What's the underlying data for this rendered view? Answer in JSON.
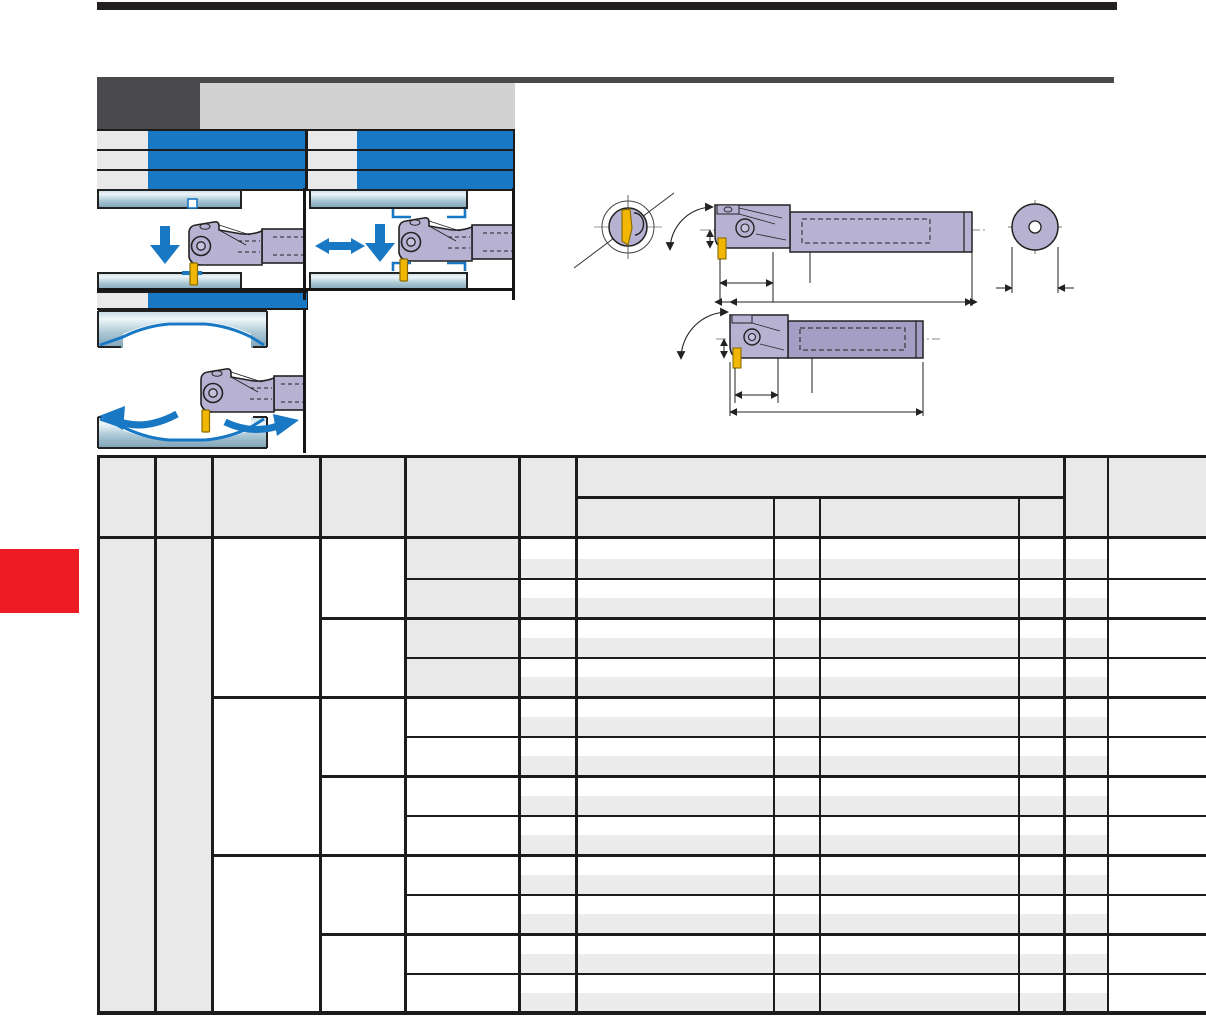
{
  "page": {
    "width": 1206,
    "height": 1016,
    "background": "#ffffff"
  },
  "colors": {
    "ink": "#231f20",
    "dark_gray": "#4a4a4c",
    "strip_gray": "#d2d2d2",
    "cell_gray": "#e9e9e9",
    "band_gray": "#ececec",
    "blue": "#1878c4",
    "red": "#ed1c24",
    "grid": "#1c1c1c",
    "steel_light": "#eef6f9",
    "steel_mid": "#a9c6d3",
    "steel_dark": "#7fa3b8",
    "tool_fill": "#b7b1d2",
    "tool_fill_dark": "#a49dc4",
    "insert_gold": "#f2b705",
    "insert_edge": "#8a6d00"
  },
  "masthead": {
    "top_bar": {
      "x": 97,
      "y": 2,
      "w": 1020,
      "h": 8
    },
    "rule": {
      "x": 97,
      "y": 77,
      "w": 1017,
      "h": 6
    },
    "dark_box": {
      "x": 97,
      "y": 77,
      "w": 103,
      "h": 52
    },
    "strip": {
      "x": 200,
      "y": 83,
      "w": 315,
      "h": 46
    }
  },
  "feature_rows": {
    "backing": {
      "x": 97,
      "y": 129,
      "w": 418,
      "h": 62
    },
    "row_ys": [
      131,
      151,
      171
    ],
    "row_h": 18,
    "groups": [
      {
        "label_x": 97,
        "label_w": 51,
        "bar_x": 148,
        "bar_w": 157
      },
      {
        "label_x": 308,
        "label_w": 49,
        "bar_x": 357,
        "bar_w": 156
      }
    ],
    "extra_row": {
      "backing": {
        "x": 97,
        "y": 291,
        "w": 211,
        "h": 19
      },
      "label": {
        "x": 97,
        "y": 293,
        "w": 51,
        "h": 15
      },
      "bar": {
        "x": 148,
        "y": 293,
        "w": 159,
        "h": 15
      }
    }
  },
  "side_tab": {
    "x": 0,
    "y": 549,
    "w": 79,
    "h": 64
  },
  "panels": {
    "items": [
      {
        "name": "diagram-face-grooving",
        "icons": [
          "down-arrow-icon"
        ]
      },
      {
        "name": "diagram-traverse-grooving",
        "icons": [
          "left-right-arrow-icon",
          "down-arrow-icon"
        ]
      },
      {
        "name": "diagram-profile-recessing",
        "icons": [
          "curve-left-arrow-icon",
          "curve-right-arrow-icon"
        ]
      }
    ]
  },
  "drawings": {
    "items": [
      "end-view-with-insert",
      "boring-bar-side-view-1",
      "shank-end-view",
      "boring-bar-side-view-2"
    ]
  },
  "table": {
    "x": 97,
    "right": 1206,
    "top": 455,
    "header_mid": 497,
    "header_bottom": 537,
    "body_top": 539,
    "body_bottom": 1013,
    "thick": 3,
    "thin": 2,
    "header_fill": {
      "x": 97,
      "y": 455,
      "w": 1109,
      "h": 82
    },
    "col_edges_thick": [
      97,
      155,
      212,
      320,
      405,
      519,
      576,
      1064
    ],
    "col_edge_thin": 1108,
    "sub_col_edges": [
      774,
      820,
      1019
    ],
    "n_pairs": 12,
    "pair_h": 39.5,
    "subrow_h": 19.75,
    "c1": {
      "x": 97,
      "w": 58
    },
    "c2": {
      "x": 155,
      "w": 57
    },
    "c5": {
      "x": 405,
      "w": 114,
      "gray_pairs": 4
    },
    "band": {
      "x": 519,
      "w": 589
    },
    "group_lines_wide": [
      697,
      855
    ],
    "group_lines_mid": [
      618,
      776,
      934
    ],
    "pair_lines": [
      578.5,
      657.5,
      736.5,
      815.5,
      894.5,
      973.5
    ],
    "pair_line_x": 405,
    "group_mid_x": 320,
    "group_wide_x": 212
  }
}
